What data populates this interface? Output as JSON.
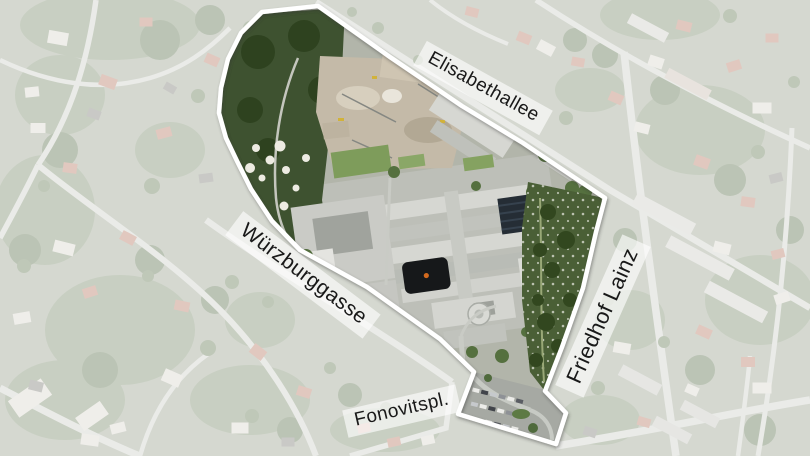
{
  "map": {
    "outline": {
      "color": "#ffffff",
      "points": "318,6 390,57 462,106 523,143 605,198 596,232 583,288 562,347 545,391 566,413 556,444 458,414 474,372 440,339 367,287 300,250 272,221 251,189 237,161 226,138 219,113 221,88 228,59 241,33 262,12"
    },
    "labels": {
      "elisabethallee": {
        "text": "Elisabethallee"
      },
      "wuerzburggasse": {
        "text": "Würzburggasse"
      },
      "friedhof_lainz": {
        "text": "Friedhof Lainz"
      },
      "fonovitsplatz": {
        "text": "Fonovitspl."
      }
    }
  }
}
